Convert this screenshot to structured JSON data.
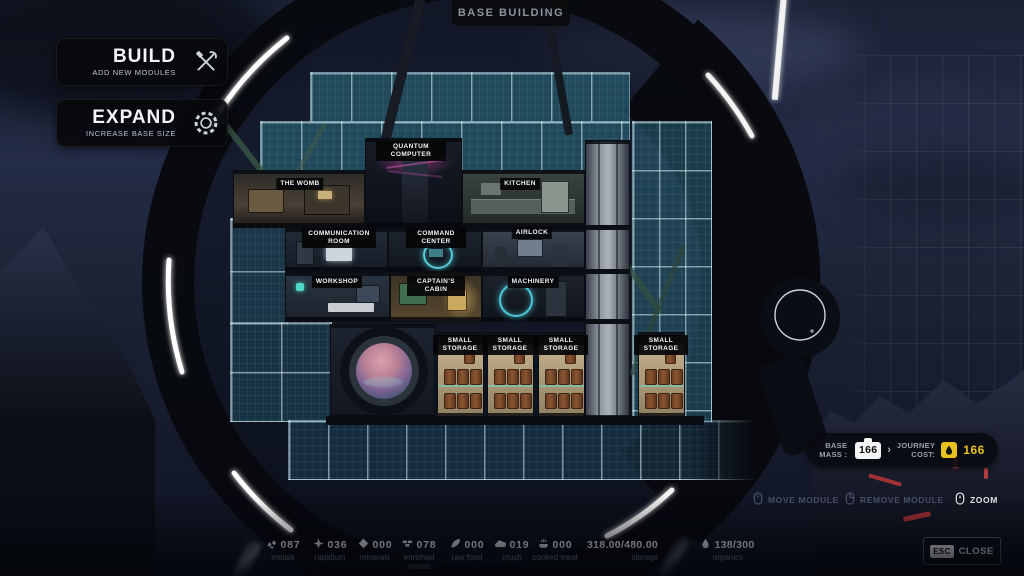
{
  "title": "BASE BUILDING",
  "left_menu": {
    "build": {
      "label": "BUILD",
      "sublabel": "ADD NEW MODULES"
    },
    "expand": {
      "label": "EXPAND",
      "sublabel": "INCREASE BASE SIZE"
    }
  },
  "modules": [
    {
      "label": "QUANTUM COMPUTER"
    },
    {
      "label": "THE WOMB"
    },
    {
      "label": "KITCHEN"
    },
    {
      "label": "COMMUNICATION ROOM"
    },
    {
      "label": "COMMAND CENTER"
    },
    {
      "label": "AIRLOCK"
    },
    {
      "label": "WORKSHOP"
    },
    {
      "label": "CAPTAIN'S CABIN"
    },
    {
      "label": "MACHINERY"
    },
    {
      "label": "SMALL STORAGE"
    },
    {
      "label": "SMALL STORAGE"
    },
    {
      "label": "SMALL STORAGE"
    },
    {
      "label": "SMALL STORAGE"
    }
  ],
  "mass_panel": {
    "base_mass_label": "BASE\nMASS :",
    "base_mass_value": "166",
    "journey_cost_label": "JOURNEY\nCOST:",
    "journey_cost_value": "166",
    "accent_color": "#e8c21f"
  },
  "hints": [
    {
      "label": "MOVE MODULE",
      "enabled": false
    },
    {
      "label": "REMOVE MODULE",
      "enabled": false
    },
    {
      "label": "ZOOM",
      "enabled": true
    }
  ],
  "close": {
    "key": "ESC",
    "label": "CLOSE"
  },
  "resources": [
    {
      "icon": "metals-icon",
      "value": "087",
      "label": "metals"
    },
    {
      "icon": "rapidium-icon",
      "value": "036",
      "label": "rapidium"
    },
    {
      "icon": "minerals-icon",
      "value": "000",
      "label": "minerals"
    },
    {
      "icon": "enriched-metals-icon",
      "value": "078",
      "label": "enriched metals"
    },
    {
      "icon": "raw-food-icon",
      "value": "000",
      "label": "raw food"
    },
    {
      "icon": "mush-icon",
      "value": "019",
      "label": "mush"
    },
    {
      "icon": "cooked-meal-icon",
      "value": "000",
      "label": "cooked meal"
    }
  ],
  "storage": {
    "value": "318.00/480.00",
    "label": "storage"
  },
  "organics": {
    "value": "138/300",
    "label": "organics"
  }
}
